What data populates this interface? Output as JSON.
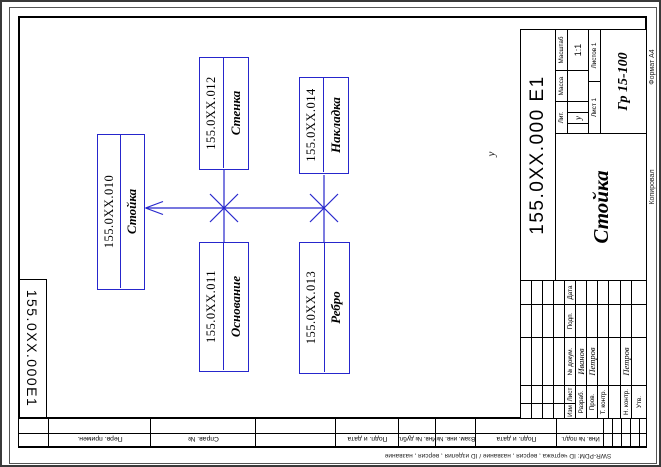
{
  "diagram": {
    "line_color": "#2626cc",
    "stray_mark": "у",
    "boxes": [
      {
        "id": "stojka",
        "number": "155.0XX.010",
        "name": "Стойка"
      },
      {
        "id": "stenka",
        "number": "155.0XX.012",
        "name": "Стенка"
      },
      {
        "id": "nakladka",
        "number": "155.0XX.014",
        "name": "Накладка"
      },
      {
        "id": "osnovanie",
        "number": "155.0XX.011",
        "name": "Основание"
      },
      {
        "id": "rebro",
        "number": "155.0XX.013",
        "name": "Ребро"
      }
    ]
  },
  "title_block": {
    "designation": "155.0XX.000 Е1",
    "name": "Стойка",
    "lit_label": "Лит.",
    "lit_value": "у",
    "mass_label": "Масса",
    "scale_label": "Масштаб",
    "scale": "1:1",
    "sheet": "Лист 1",
    "sheets": "Листов 1",
    "group": "Гр 15-100",
    "header_cols": [
      "Изм",
      "Лист",
      "№ докум.",
      "Подп.",
      "Дата"
    ],
    "rows": [
      {
        "label": "Разраб.",
        "name": "Иванов"
      },
      {
        "label": "Пров.",
        "name": "Петров"
      },
      {
        "label": "Т. контр.",
        "name": ""
      },
      {
        "label": "Н. контр.",
        "name": "Петров"
      },
      {
        "label": "Утв.",
        "name": ""
      }
    ]
  },
  "margins": {
    "corner_designation": "155.0XX.000Е1",
    "bottom_cells": [
      "Перв. примен.",
      "Справ. №",
      "Подп. и дата",
      "Инв. № дубл.",
      "Взам. инв. №",
      "Подп. и дата",
      "Инв. № подл."
    ],
    "right_format": "Формат А4",
    "right_copy": "Копировал",
    "footer_stamp": "SWR-PDM: ID чертежа , версия , название / ID изделия , версия , название"
  }
}
